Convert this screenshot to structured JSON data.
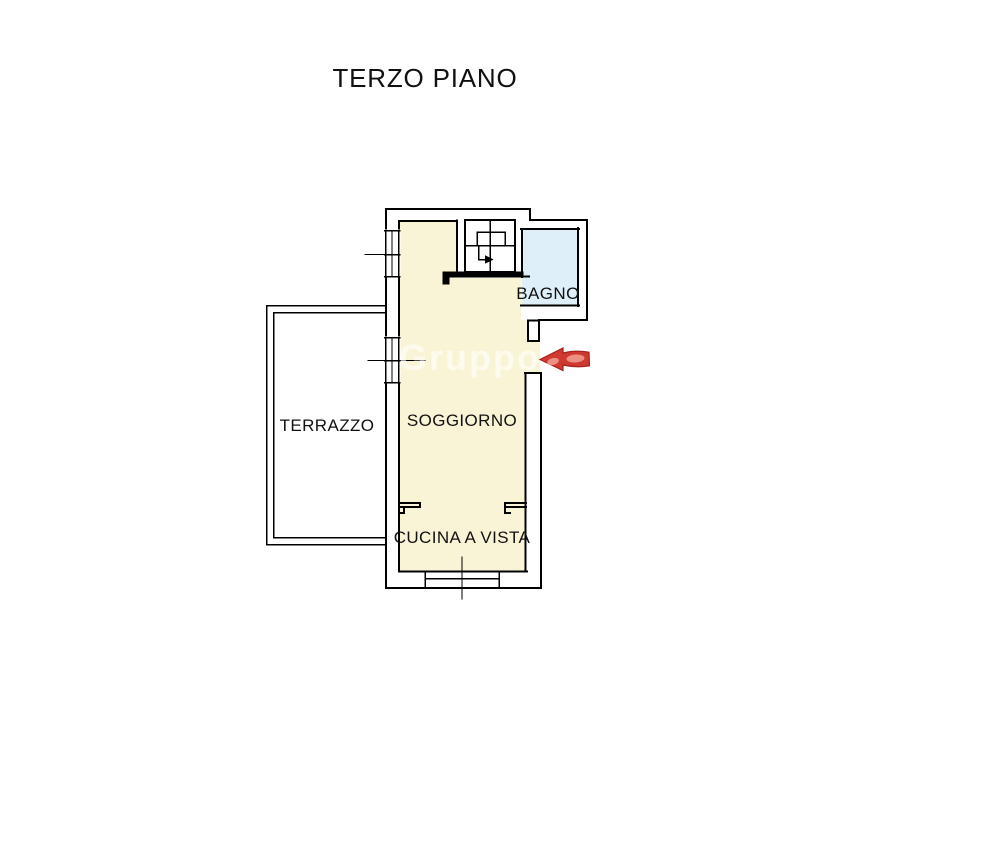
{
  "page": {
    "title": "TERZO PIANO",
    "background": "#FFFFFF"
  },
  "floorplan": {
    "watermark": "Gruppo",
    "watermark_color": "#FFFFFF",
    "rooms": [
      {
        "id": "terrazzo",
        "name": "TERRAZZO",
        "fill": "#FFFFFF"
      },
      {
        "id": "soggiorno",
        "name": "SOGGIORNO",
        "fill": "#FAF4D6"
      },
      {
        "id": "bagno",
        "name": "BAGNO",
        "fill": "#DFEFF9"
      },
      {
        "id": "cucina",
        "name": "CUCINA A VISTA",
        "fill": "#FAF4D6"
      }
    ],
    "colors": {
      "wall": "#000000",
      "label": "#111111"
    },
    "entrance_arrow": {
      "fill": "#CF3A30",
      "outline": "#A8211D",
      "highlight": "#F09A8E"
    }
  }
}
